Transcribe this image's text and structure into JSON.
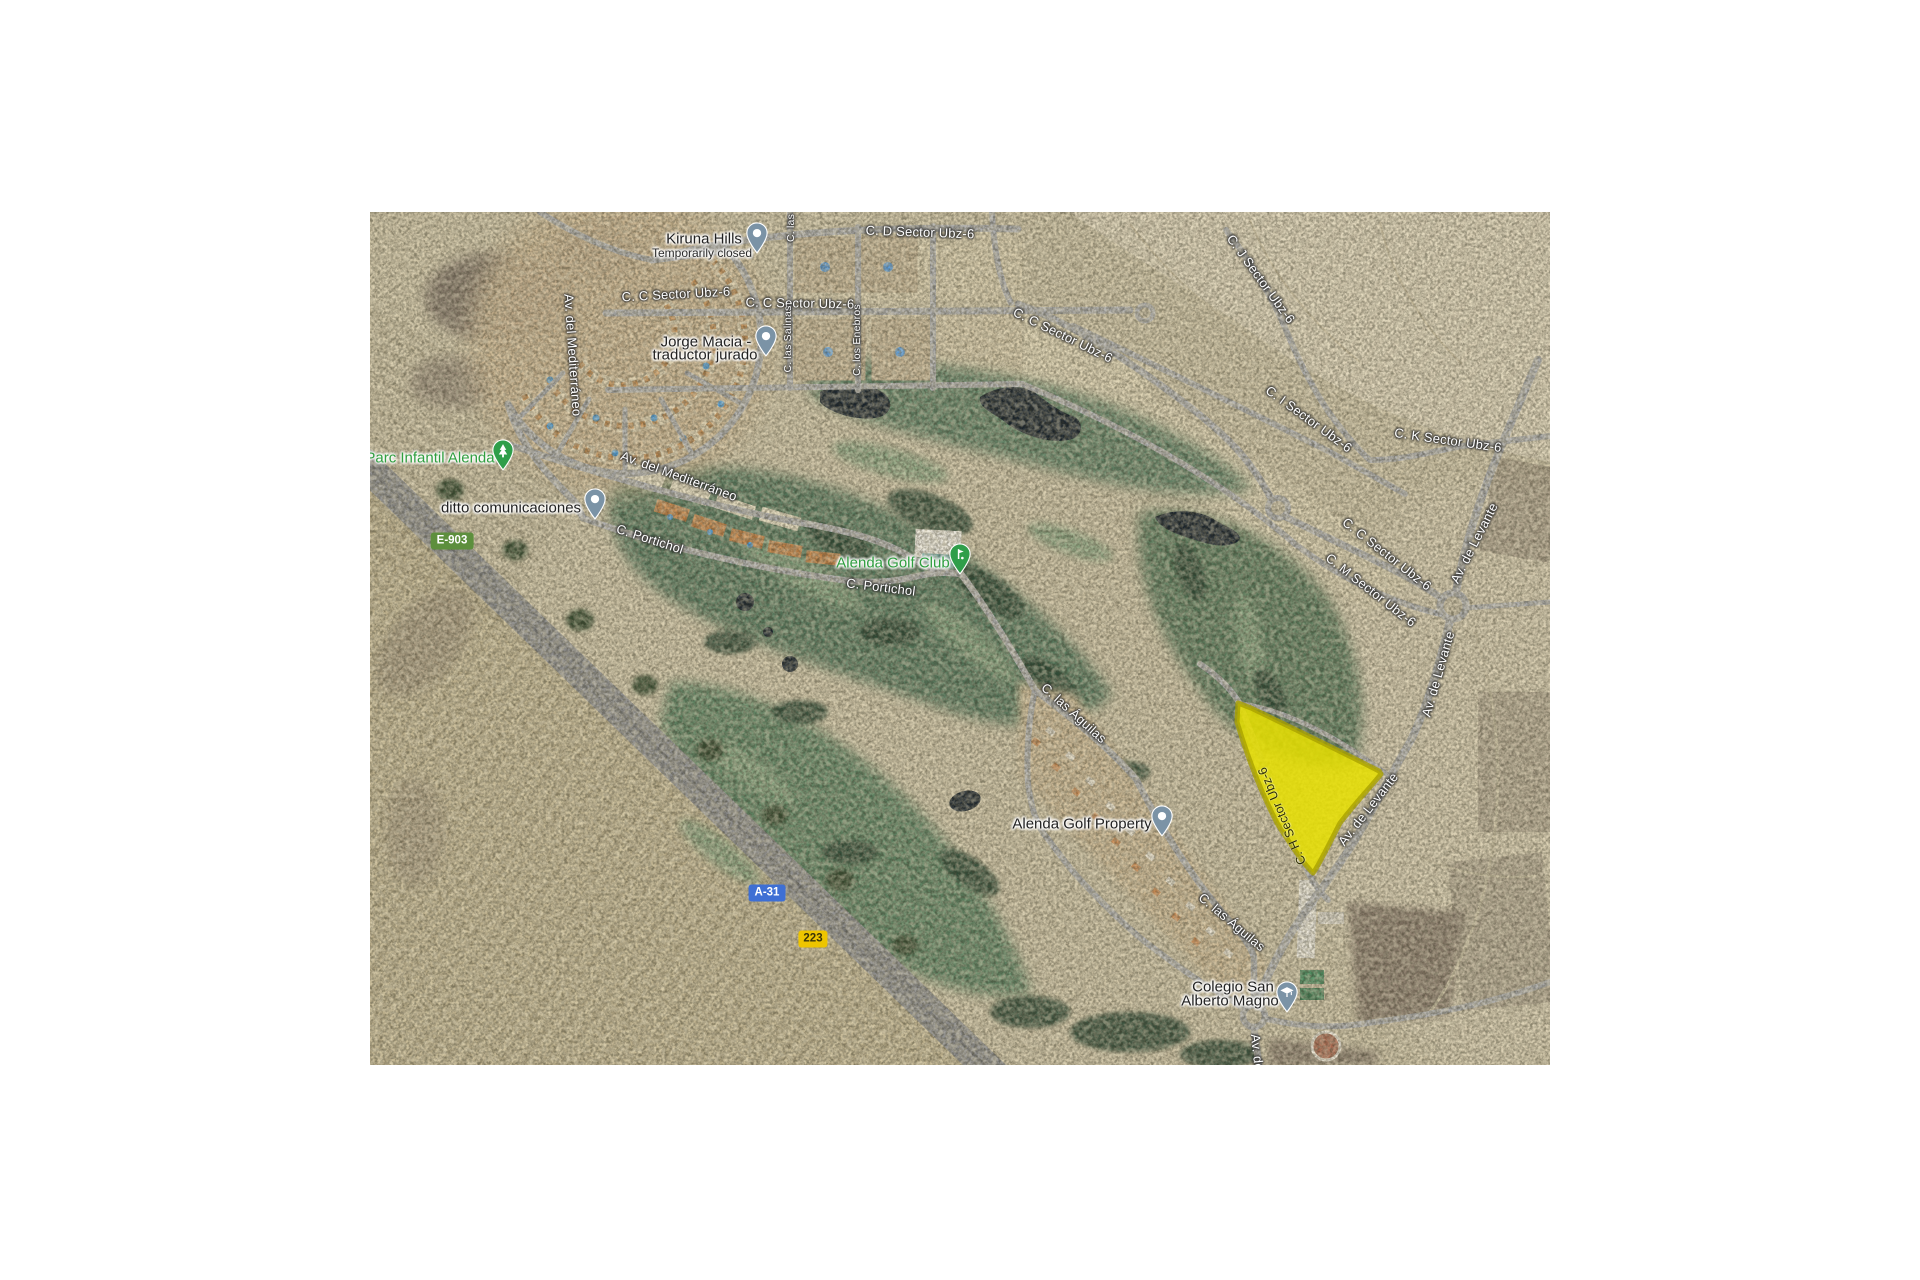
{
  "map": {
    "description": "Satellite map of Alenda Golf area with highlighted parcel",
    "highlight": {
      "fill": "#e8e000",
      "border": "#a9a100"
    },
    "road_labels": [
      {
        "text": "C. D Sector Ubz-6"
      },
      {
        "text": "C. C Sector Ubz-6"
      },
      {
        "text": "C. C Sector Ubz-6"
      },
      {
        "text": "C. C Sector Ubz-6"
      },
      {
        "text": "C. J Sector Ubz-6"
      },
      {
        "text": "C. I Sector Ubz-6"
      },
      {
        "text": "C. K Sector Ubz-6"
      },
      {
        "text": "C. C Sector Ubz-6"
      },
      {
        "text": "C. M Sector Ubz-6"
      },
      {
        "text": "Av. de Levante"
      },
      {
        "text": "Av. de Levante"
      },
      {
        "text": "Av. del Mediterráneo"
      },
      {
        "text": "Av. del Mediterráneo"
      },
      {
        "text": "C. Portichol"
      },
      {
        "text": "C. Portichol"
      },
      {
        "text": "C. las Águilas"
      },
      {
        "text": "C. las Águilas"
      },
      {
        "text": "C. las Salinas"
      },
      {
        "text": "C. los Enebros"
      },
      {
        "text": "C. las"
      },
      {
        "text": "C. H Sector Ubz-6"
      },
      {
        "text": "Av. de Levante"
      },
      {
        "text": "Av. de Levante"
      }
    ],
    "pois": {
      "kiruna": {
        "name": "Kiruna Hills",
        "status": "Temporarily closed",
        "pin": "generic-pin",
        "pin_color": "#7b93a6"
      },
      "jorge": {
        "line1": "Jorge Macia -",
        "line2": "traductor jurado",
        "pin": "generic-pin",
        "pin_color": "#7b93a6"
      },
      "parc": {
        "name": "Parc Infantil Alenda",
        "pin": "tree-pin",
        "pin_color": "#2f9e4a",
        "text_color": "#2f9e3f"
      },
      "ditto": {
        "name": "ditto comunicaciones",
        "pin": "generic-pin",
        "pin_color": "#7b93a6"
      },
      "golf_club": {
        "name": "Alenda Golf Club",
        "pin": "golf-pin",
        "pin_color": "#2f9e4a",
        "text_color": "#2f9e3f"
      },
      "golf_property": {
        "name": "Alenda Golf Property",
        "pin": "generic-pin",
        "pin_color": "#7b93a6"
      },
      "colegio": {
        "line1": "Colegio San",
        "line2": "Alberto Magno",
        "pin": "school-pin",
        "pin_color": "#7b93a6"
      }
    },
    "shields": {
      "e903": {
        "text": "E-903",
        "color": "#5d8f3d"
      },
      "a31": {
        "text": "A-31",
        "color": "#3e6fd4"
      },
      "r223": {
        "text": "223",
        "color": "#eec500"
      }
    }
  }
}
